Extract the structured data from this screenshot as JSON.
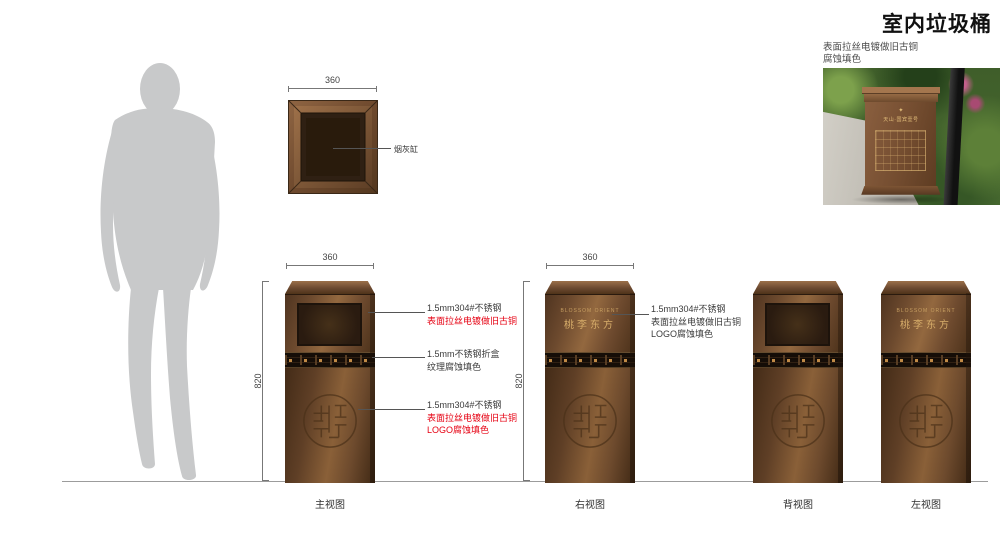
{
  "title": "室内垃圾桶",
  "photo": {
    "caption": [
      "表面拉丝电镀做旧古铜",
      "腐蚀填色"
    ],
    "bin_mark": "✦",
    "bin_text": "天山·国宾壹号"
  },
  "top_view": {
    "dim_width": "360",
    "callout": "烟灰缸"
  },
  "brand": {
    "en": "BLOSSOM ORIENT",
    "cn": "桃李东方"
  },
  "views": {
    "front": {
      "label": "主视图",
      "dim_width": "360",
      "dim_height": "820"
    },
    "right": {
      "label": "右视图",
      "dim_width": "360",
      "dim_height": "820"
    },
    "back": {
      "label": "背视图"
    },
    "left": {
      "label": "左视图"
    }
  },
  "annotations": {
    "front_opening": {
      "l1": "1.5mm304#不锈钢",
      "l2": "表面拉丝电镀做旧古铜"
    },
    "front_band": {
      "l1": "1.5mm不锈钢折盒",
      "l2": "纹理腐蚀填色"
    },
    "front_logo": {
      "l1": "1.5mm304#不锈钢",
      "l2": "表面拉丝电镀做旧古铜",
      "l3": "LOGO腐蚀填色"
    },
    "right_panel": {
      "l1": "1.5mm304#不锈钢",
      "l2": "表面拉丝电镀做旧古铜",
      "l3": "LOGO腐蚀填色"
    }
  },
  "colors": {
    "bronze": "#7a5336",
    "gold": "#c79f62",
    "red": "#e60012",
    "silhouette": "#c8c9ca"
  }
}
